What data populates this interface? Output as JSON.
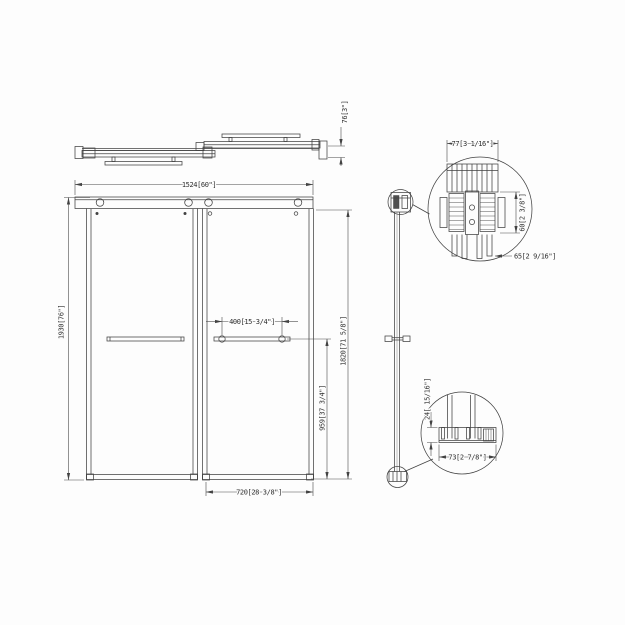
{
  "colors": {
    "line": "#424242",
    "text": "#2e2e2e",
    "background": "#fdfdfd"
  },
  "dims": {
    "track_depth": "76[3\"]",
    "overall_width": "1524[60\"]",
    "overall_height": "1930[76\"]",
    "handle_hole_spacing": "400[15 3/4\"]",
    "glass_height": "1820[71 5/8\"]",
    "handle_height": "959[37 3/4\"]",
    "panel_width": "720[28 3/8\"]",
    "roller_width": "77[3 1/16\"]",
    "roller_height": "60[2 3/8\"]",
    "roller_depth": "65[2 9/16\"]",
    "guide_height": "24[ 15/16\"]",
    "guide_width": "73[2 7/8\"]"
  }
}
